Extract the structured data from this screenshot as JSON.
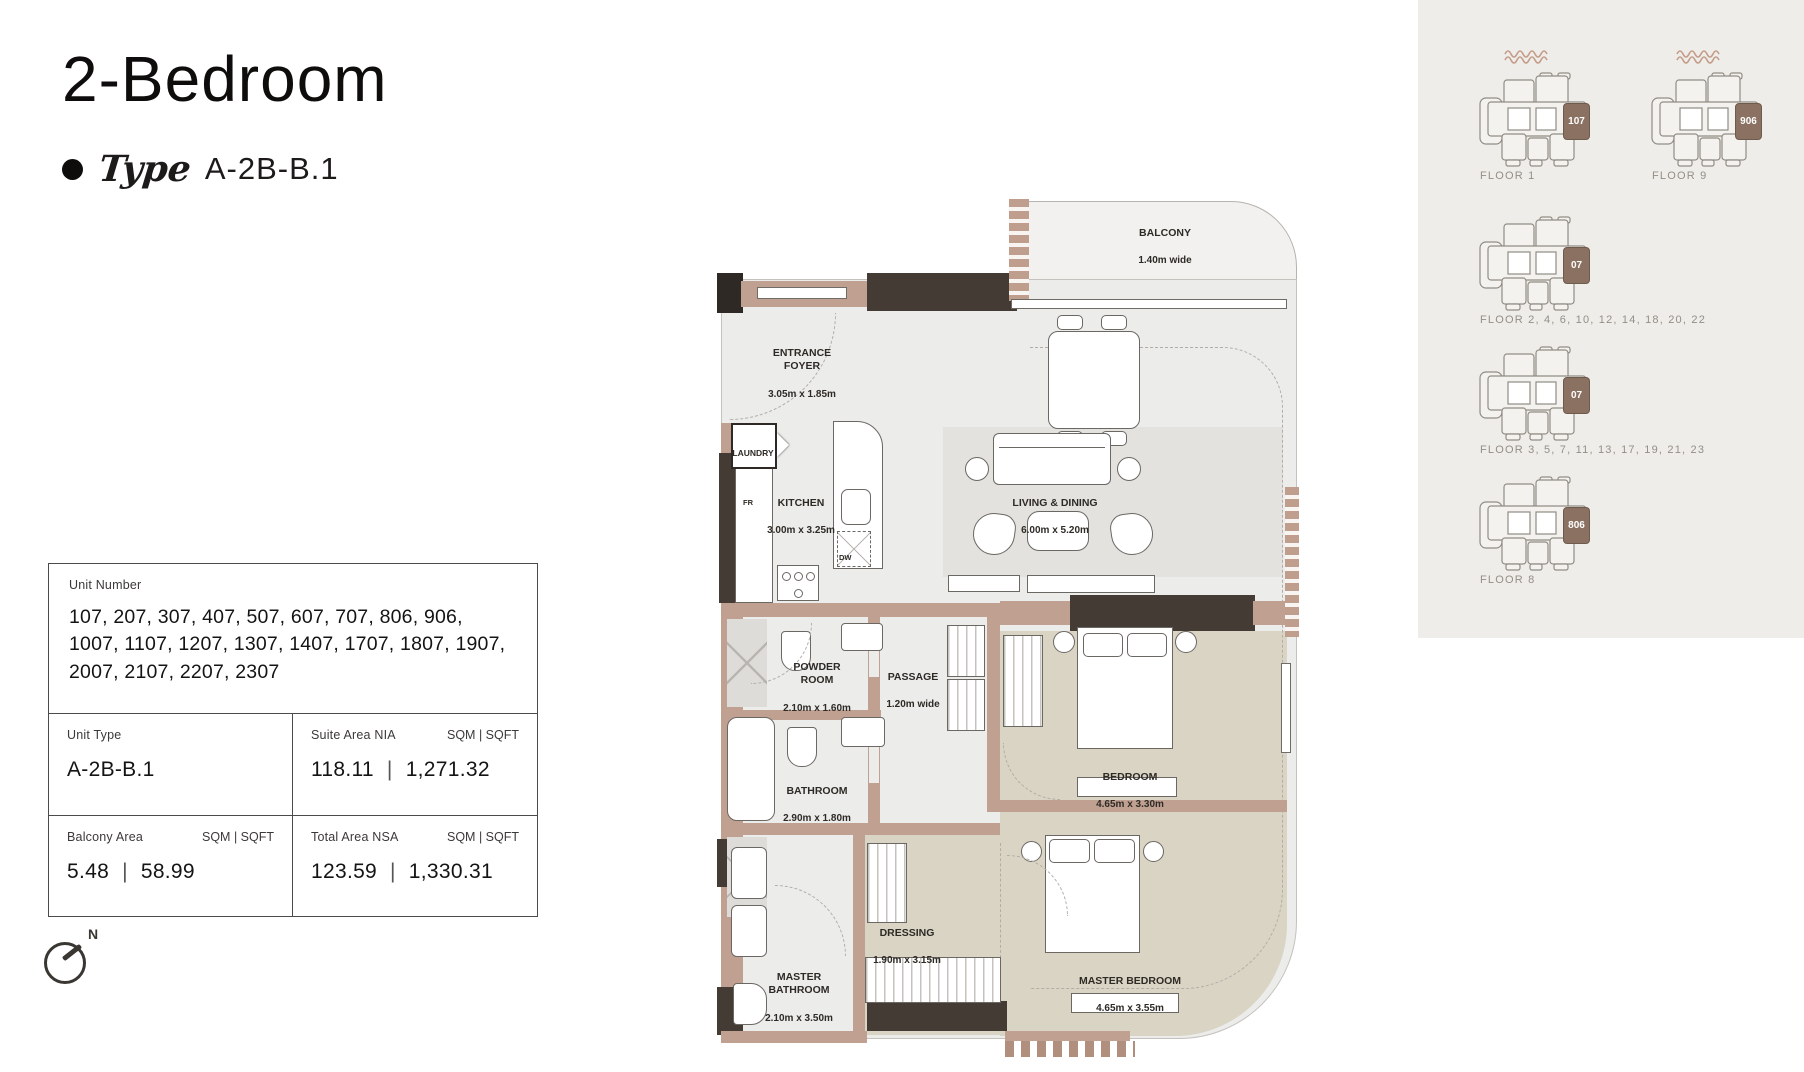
{
  "page": {
    "title": "2-Bedroom",
    "type_label": "Type",
    "type_value": "A-2B-B.1"
  },
  "info_table": {
    "separator": "|",
    "unit_number": {
      "label": "Unit Number",
      "value": "107, 207, 307, 407, 507, 607, 707, 806, 906, 1007, 1107, 1207, 1307, 1407, 1707, 1807, 1907, 2007, 2107, 2207, 2307"
    },
    "unit_type": {
      "label": "Unit Type",
      "value": "A-2B-B.1"
    },
    "suite_area": {
      "label": "Suite Area NIA",
      "units": "SQM | SQFT",
      "sqm": "118.11",
      "sqft": "1,271.32"
    },
    "balcony_area": {
      "label": "Balcony Area",
      "units": "SQM | SQFT",
      "sqm": "5.48",
      "sqft": "58.99"
    },
    "total_area": {
      "label": "Total Area NSA",
      "units": "SQM | SQFT",
      "sqm": "123.59",
      "sqft": "1,330.31"
    }
  },
  "compass": {
    "north_label": "N"
  },
  "floor_plan": {
    "rooms": {
      "balcony": {
        "name": "BALCONY",
        "dims": "1.40m wide"
      },
      "entrance_foyer": {
        "name": "ENTRANCE\nFOYER",
        "dims": "3.05m x 1.85m"
      },
      "laundry": {
        "name": "LAUNDRY"
      },
      "kitchen": {
        "name": "KITCHEN",
        "dims": "3.00m x 3.25m"
      },
      "living_dining": {
        "name": "LIVING & DINING",
        "dims": "6.00m x 5.20m"
      },
      "powder_room": {
        "name": "POWDER\nROOM",
        "dims": "2.10m x 1.60m"
      },
      "passage": {
        "name": "PASSAGE",
        "dims": "1.20m wide"
      },
      "bathroom": {
        "name": "BATHROOM",
        "dims": "2.90m x 1.80m"
      },
      "bedroom": {
        "name": "BEDROOM",
        "dims": "4.65m x 3.30m"
      },
      "dressing": {
        "name": "DRESSING",
        "dims": "1.90m x 3.15m"
      },
      "master_bathroom": {
        "name": "MASTER\nBATHROOM",
        "dims": "2.10m x 3.50m"
      },
      "master_bedroom": {
        "name": "MASTER BEDROOM",
        "dims": "4.65m x 3.55m"
      }
    },
    "appliance_labels": {
      "fridge": "FR",
      "dishwasher": "DW"
    }
  },
  "key_plans": {
    "items": [
      {
        "floor_label": "FLOOR 1",
        "unit": "107",
        "waves": true
      },
      {
        "floor_label": "FLOOR 9",
        "unit": "906",
        "waves": true
      },
      {
        "floor_label": "FLOOR 2, 4, 6, 10, 12, 14, 18, 20, 22",
        "unit": "07",
        "waves": false
      },
      {
        "floor_label": "FLOOR 3, 5, 7, 11, 13, 17, 19, 21, 23",
        "unit": "07",
        "waves": false
      },
      {
        "floor_label": "FLOOR 8",
        "unit": "806",
        "waves": false
      }
    ]
  },
  "colors": {
    "wall_tan": "#c0a191",
    "wall_dark": "#443b35",
    "floor_beige": "#d9d4c3",
    "floor_gray": "#ececeb",
    "panel_bg": "#efede9",
    "unit_highlight": "#8b7162"
  }
}
